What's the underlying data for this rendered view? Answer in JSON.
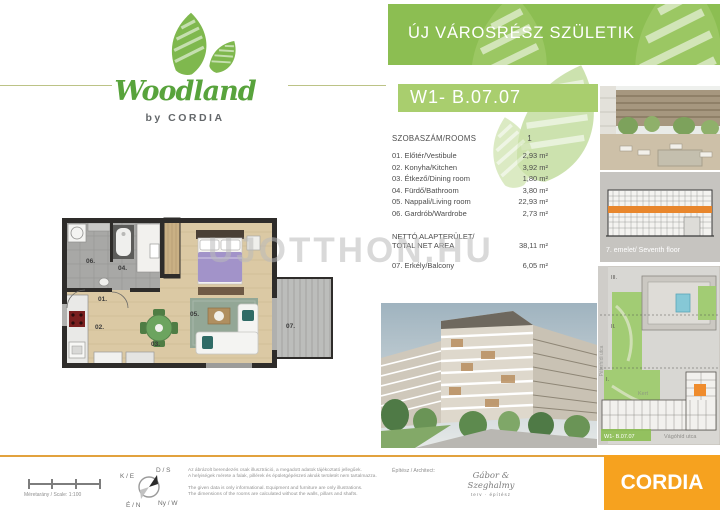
{
  "header": {
    "title": "ÚJ VÁROSRÉSZ SZÜLETIK",
    "unit_code": "W1- B.07.07"
  },
  "brand_logo": {
    "name": "Woodland",
    "byline": "by CORDIA"
  },
  "watermark": "UJOTTHON.HU",
  "room_table": {
    "header_label": "SZOBASZÁM/ROOMS",
    "header_value": "1",
    "rows": [
      {
        "num": "01.",
        "label": "01. Előtér/Vestibule",
        "area": "2,93 m²"
      },
      {
        "num": "02.",
        "label": "02. Konyha/Kitchen",
        "area": "3,92 m²"
      },
      {
        "num": "03.",
        "label": "03. Étkező/Dining room",
        "area": "1,80 m²"
      },
      {
        "num": "04.",
        "label": "04. Fürdő/Bathroom",
        "area": "3,80 m²"
      },
      {
        "num": "05.",
        "label": "05. Nappali/Living room",
        "area": "22,93 m²"
      },
      {
        "num": "06.",
        "label": "06. Gardrób/Wardrobe",
        "area": "2,73 m²"
      }
    ],
    "net_label_line1": "NETTÓ ALAPTERÜLET/",
    "net_label_line2": "TOTAL NET AREA",
    "net_value": "38,11 m²",
    "balcony_row": {
      "label": "07. Erkély/Balcony",
      "area": "6,05 m²"
    }
  },
  "floor_plan": {
    "room_labels": {
      "r01": "01.",
      "r02": "02.",
      "r03": "03.",
      "r04": "04.",
      "r05": "05.",
      "r06": "06.",
      "r07": "07."
    }
  },
  "side_panels": {
    "floor_caption": "7. emelet/ Seventh floor"
  },
  "site_map": {
    "zone_3": "III.",
    "zone_2": "II.",
    "zone_1": "I.",
    "garden_label": "Kert",
    "street_left": "Péterhídi utca",
    "street_bottom": "Vágóhíd utca",
    "unit_badge": "W1- B.07.07"
  },
  "footer": {
    "scale_label": "Méretarány / Scale: 1:100",
    "compass": {
      "north": "É / N",
      "south": "D / S",
      "east": "K / E",
      "west": "Ny / W"
    },
    "disclaimer_hu_1": "Az ábrázolt berendezés csak illusztráció, a megadott adatok tájékoztató jellegűek.",
    "disclaimer_hu_2": "A helyiségek mérete a falak, pillérek és épületgépészeti aknák területét nem tartalmazza.",
    "disclaimer_en_1": "The given data is only informational. Equipment and furniture are only illustrations.",
    "disclaimer_en_2": "The dimensions of the rooms are calculated without the walls, pillars and shafts.",
    "architect_label": "Építész / Architect:",
    "architect_name": "Gábor & Szeghalmy",
    "architect_sub": "terv · építész",
    "brand": "CORDIA"
  },
  "colors": {
    "banner_green": "#8cbe52",
    "unit_box_green": "#a9ce6e",
    "logo_green": "#58a33c",
    "cordia_orange": "#f6a21f",
    "unit_highlight_orange": "#ef8c2d",
    "floor_band_orange": "#e8862c"
  }
}
